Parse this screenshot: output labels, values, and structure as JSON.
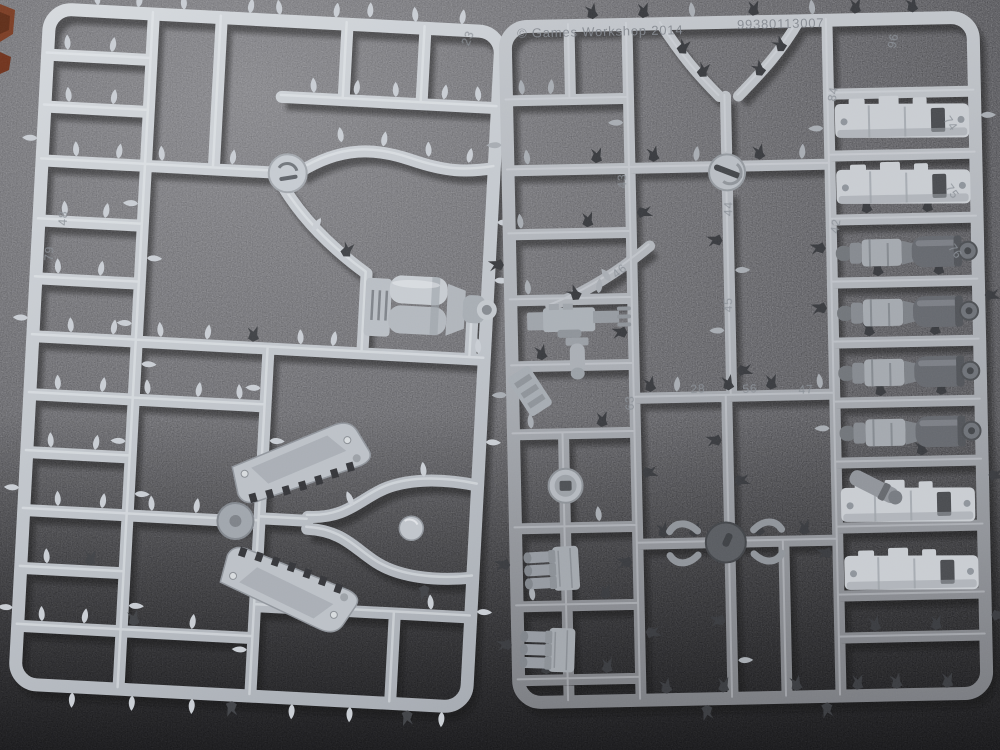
{
  "scene": {
    "subject": "Two grey plastic model-kit sprues photographed on dark speckled foam",
    "colors": {
      "background_top": "#6a6a6e",
      "background_bottom": "#17171a",
      "sprue_light": "#d6dade",
      "sprue_dark": "#77797e",
      "part_grey": "#9aa0a6",
      "dark_stub": "#3a3c40",
      "brown_object": "#7a3a20"
    }
  },
  "right_sprue": {
    "copyright": "© Games Workshop 2014",
    "product_code": "99380113007",
    "part_numbers": {
      "96": "96",
      "84": "84",
      "42": "42",
      "74": "74",
      "75": "75",
      "76": "76",
      "43": "43",
      "44": "44",
      "45": "45",
      "46": "46",
      "63": "63",
      "28": "28",
      "56": "56",
      "47": "47"
    }
  },
  "left_sprue": {
    "part_numbers": {
      "79": "79",
      "48": "48",
      "23": "23"
    }
  }
}
